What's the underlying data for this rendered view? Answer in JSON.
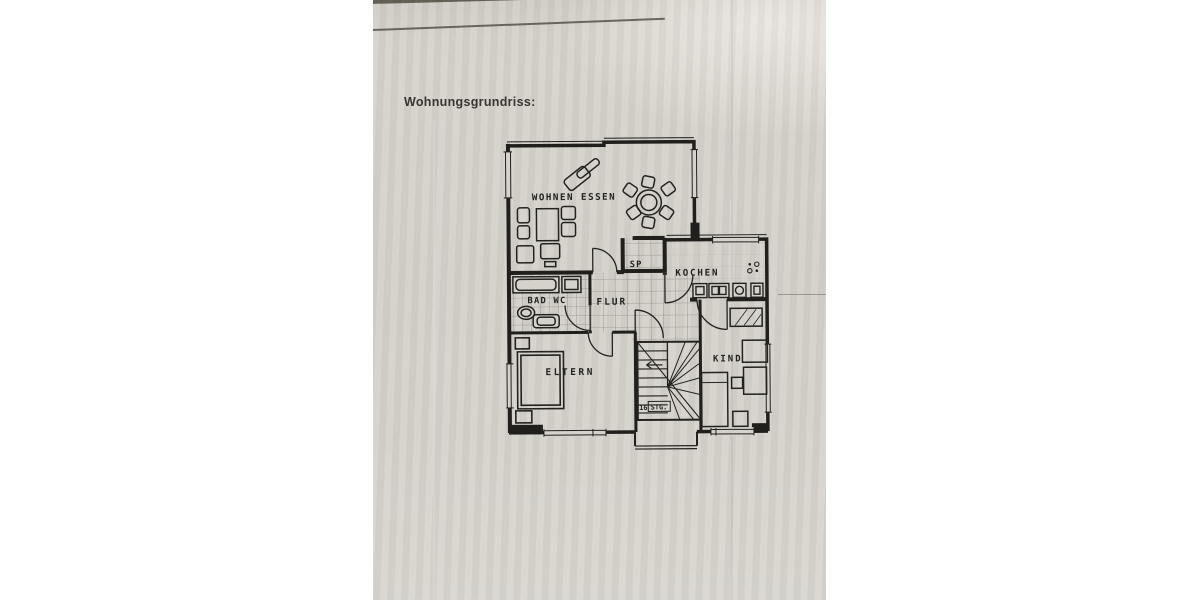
{
  "document": {
    "title": "Wohnungsgrundriss:"
  },
  "floorplan": {
    "rooms": {
      "living": {
        "label": "WOHNEN ESSEN"
      },
      "pantry": {
        "label": "SP"
      },
      "kitchen": {
        "label": "KOCHEN"
      },
      "bath": {
        "label": "BAD WC"
      },
      "hall": {
        "label": "FLUR"
      },
      "parents": {
        "label": "ELTERN"
      },
      "child": {
        "label": "KIND"
      }
    },
    "stairs": {
      "count": "16",
      "unit": "STG."
    }
  },
  "colors": {
    "paper": "#d5d2cb",
    "ink": "#23221f"
  }
}
